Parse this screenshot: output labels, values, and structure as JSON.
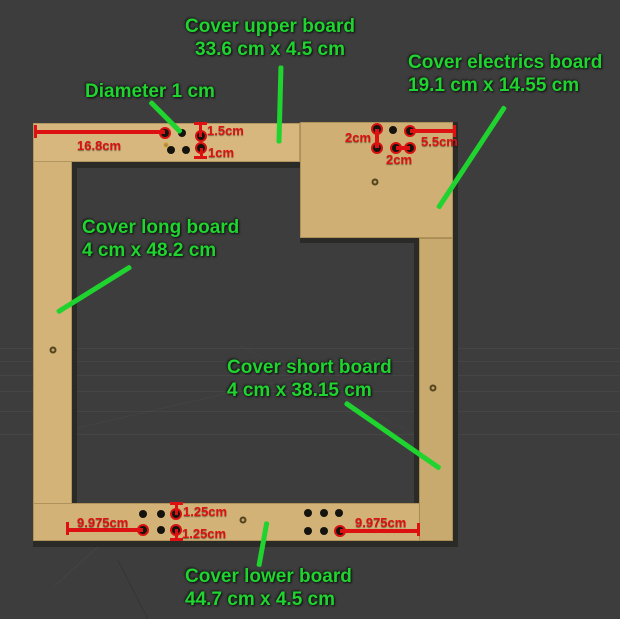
{
  "viewport": {
    "background": "#3d3d3d"
  },
  "colors": {
    "label_green": "#1fd42f",
    "dimension_red": "#dd1111",
    "board_tan_light": "#d7b77d",
    "board_tan_dark": "#c9aa6e"
  },
  "labels": {
    "upper_board": {
      "title": "Cover upper board",
      "size": "33.6 cm x 4.5 cm"
    },
    "electrics_board": {
      "title": "Cover electrics board",
      "size": "19.1 cm x 14.55 cm"
    },
    "diameter": {
      "title": "Diameter 1 cm"
    },
    "long_board": {
      "title": "Cover long board",
      "size": "4 cm x 48.2 cm"
    },
    "short_board": {
      "title": "Cover short board",
      "size": "4 cm x 38.15 cm"
    },
    "lower_board": {
      "title": "Cover lower board",
      "size": "44.7 cm x 4.5 cm"
    }
  },
  "dimensions": {
    "upper_left_offset": "16.8cm",
    "upper_hole_top": "1.5cm",
    "upper_hole_bottom": "1cm",
    "electrics_vertical": "2cm",
    "electrics_right": "5.5cm",
    "electrics_bottom": "2cm",
    "lower_left_offset": "9.975cm",
    "lower_hole_top": "1.25cm",
    "lower_hole_bottom": "1.25cm",
    "lower_right_offset": "9.975cm"
  }
}
